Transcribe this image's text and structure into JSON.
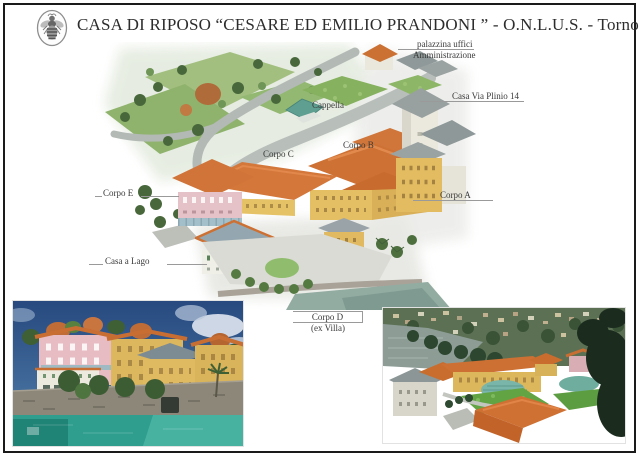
{
  "page": {
    "title": "CASA DI RIPOSO “CESARE ED EMILIO PRANDONI ” - O.N.L.U.S. - Torno",
    "logo_icon": "bee-emblem-icon"
  },
  "aerial_view": {
    "labels": {
      "palazzina_line1": "palazzina uffici",
      "palazzina_line2": "Amministrazione",
      "casa_via_plinio": "Casa Via Plinio 14",
      "cappella": "Cappella",
      "corpo_b": "Corpo B",
      "corpo_c": "Corpo C",
      "corpo_e": "Corpo E",
      "corpo_a": "Corpo A",
      "casa_a_lago": "Casa a Lago",
      "corpo_d_line1": "Corpo D",
      "corpo_d_line2": "(ex Villa)"
    }
  },
  "colors": {
    "roof_orange": "#cd7134",
    "facade_yellow": "#e3bc61",
    "facade_pink": "#e5c2c8",
    "lawn_green": "#86b15e",
    "tree_green": "#48683c",
    "path_gray": "#b8beba",
    "chapel_teal": "#5f9f92",
    "water_teal": "#2f9e8e",
    "sky_blue": "#2b4d85",
    "lake_gray": "#8d9d96",
    "frame_black": "#1a1a1a"
  }
}
